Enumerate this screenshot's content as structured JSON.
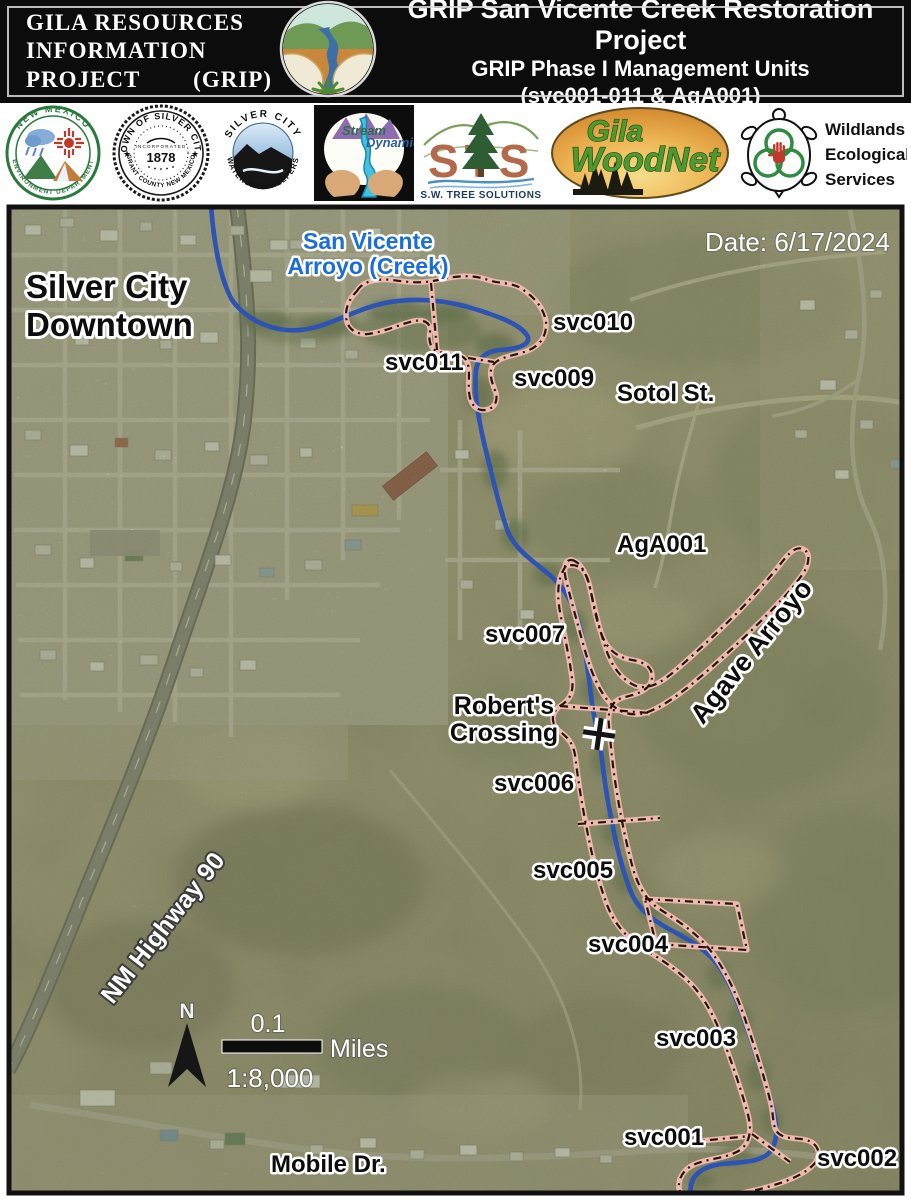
{
  "header": {
    "org_line1": "GILA RESOURCES",
    "org_line2": "INFORMATION",
    "org_line3a": "PROJECT",
    "org_line3b": "(GRIP)",
    "title_line1": "GRIP San Vicente Creek Restoration Project",
    "title_line2": "GRIP Phase I Management Units",
    "title_line3": "(svc001-011 & AgA001)"
  },
  "logos": {
    "nmed": {
      "arc_top": "NEW MEXICO",
      "arc_bottom": "ENVIRONMENT DEPARTMENT"
    },
    "town_seal": {
      "arc_top": "TOWN OF SILVER CITY",
      "incorporated": "INCORPORATED",
      "year": "1878",
      "arc_bottom": "GRANT COUNTY NEW MEXICO"
    },
    "watershed": {
      "arc_top": "SILVER CITY",
      "arc_bottom": "WATERSHED KEEPERS"
    },
    "stream_dynamics": {
      "word1": "Stream",
      "word2": "Dynamics"
    },
    "sts": {
      "letters": "STS",
      "caption": "S.W. TREE SOLUTIONS"
    },
    "woodnet": {
      "word1": "Gila",
      "word2": "WoodNet"
    },
    "wildlands": {
      "line1": "Wildlands",
      "line2": "Ecological",
      "line3": "Services"
    }
  },
  "map": {
    "date_label": "Date: 6/17/2024",
    "labels": {
      "city1": "Silver City",
      "city2": "Downtown",
      "creek1": "San Vicente",
      "creek2": "Arroyo (Creek)",
      "highway": "NM Highway 90",
      "sotol": "Sotol St.",
      "mobile": "Mobile Dr.",
      "agave": "Agave Arroyo",
      "crossing1": "Robert's",
      "crossing2": "Crossing"
    },
    "units": {
      "svc001": "svc001",
      "svc002": "svc002",
      "svc003": "svc003",
      "svc004": "svc004",
      "svc005": "svc005",
      "svc006": "svc006",
      "svc007": "svc007",
      "svc009": "svc009",
      "svc010": "svc010",
      "svc011": "svc011",
      "aga001": "AgA001"
    },
    "scale": {
      "north": "N",
      "distance": "0.1",
      "unit": "Miles",
      "ratio": "1:8,000"
    },
    "colors": {
      "unit_outline": "#f3bcb1",
      "unit_dash": "#26140c",
      "creek": "#2d54b4",
      "creek_label": "#1b6ed6"
    }
  }
}
